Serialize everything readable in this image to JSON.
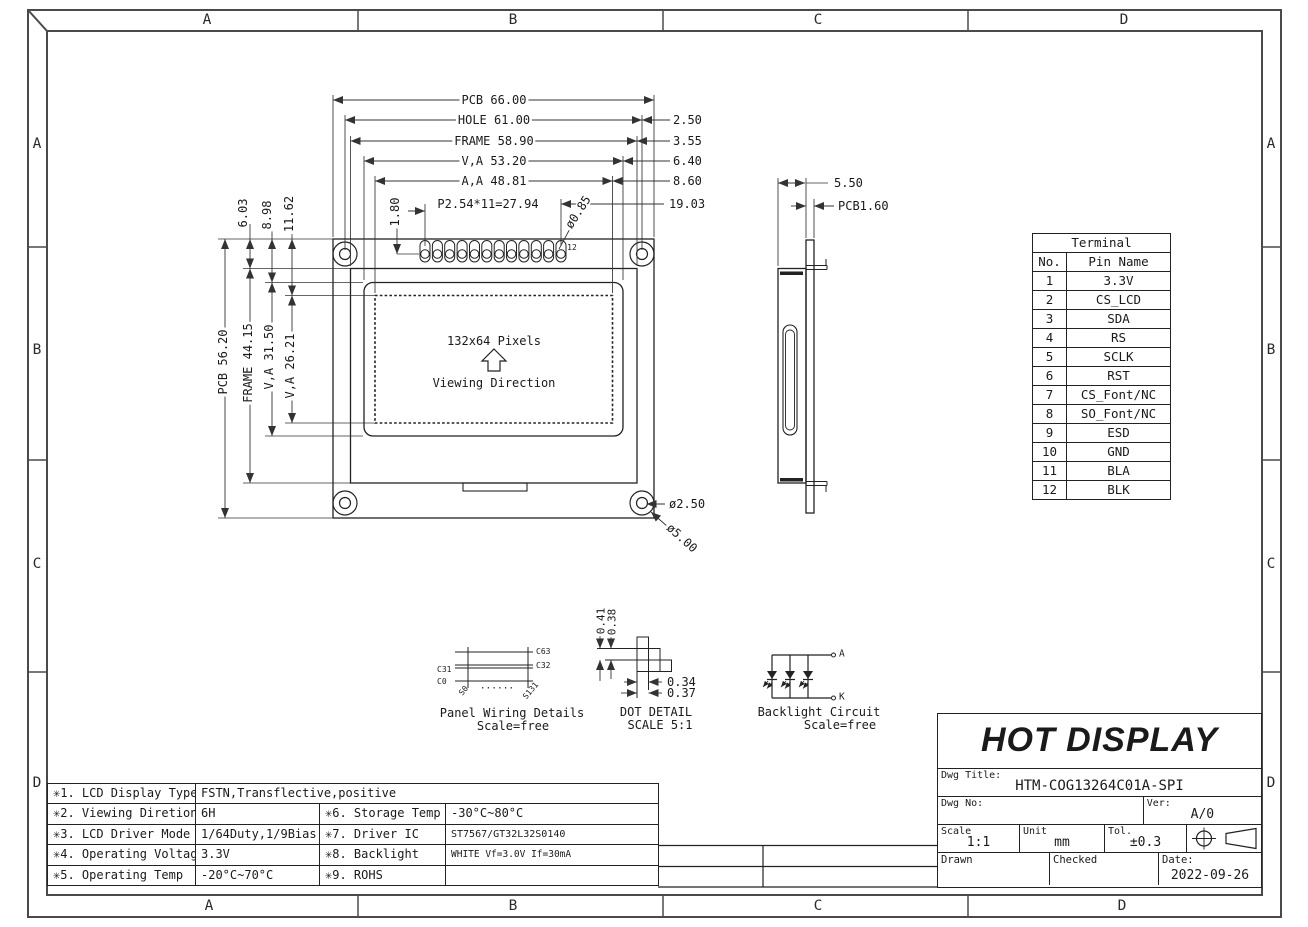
{
  "zones": {
    "cols": [
      "A",
      "B",
      "C",
      "D"
    ],
    "rows": [
      "A",
      "B",
      "C",
      "D"
    ]
  },
  "front_view": {
    "dims_top": [
      "PCB 66.00",
      "HOLE 61.00",
      "FRAME 58.90",
      "V,A 53.20",
      "A,A 48.81"
    ],
    "dims_right": [
      "2.50",
      "3.55",
      "6.40",
      "8.60",
      "19.03"
    ],
    "dims_left_upper": [
      "6.03",
      "8.98",
      "11.62"
    ],
    "dims_left": [
      "PCB 56.20",
      "FRAME 44.15",
      "V,A 31.50",
      "V,A 26.21"
    ],
    "pin_pitch": "P2.54*11=27.94",
    "pin_offset": "1.80",
    "pin_hole_dia": "ø0.85",
    "pin_last_no": "12",
    "pixels": "132x64 Pixels",
    "viewing": "Viewing Direction",
    "hole_dia": "ø2.50",
    "pad_dia": "ø5.00"
  },
  "side_view": {
    "thickness": "5.50",
    "pcb": "PCB1.60"
  },
  "terminal": {
    "title": "Terminal",
    "col_no": "No.",
    "col_name": "Pin Name",
    "rows": [
      {
        "no": "1",
        "name": "3.3V"
      },
      {
        "no": "2",
        "name": "CS_LCD"
      },
      {
        "no": "3",
        "name": "SDA"
      },
      {
        "no": "4",
        "name": "RS"
      },
      {
        "no": "5",
        "name": "SCLK"
      },
      {
        "no": "6",
        "name": "RST"
      },
      {
        "no": "7",
        "name": "CS_Font/NC"
      },
      {
        "no": "8",
        "name": "SO_Font/NC"
      },
      {
        "no": "9",
        "name": "ESD"
      },
      {
        "no": "10",
        "name": "GND"
      },
      {
        "no": "11",
        "name": "BLA"
      },
      {
        "no": "12",
        "name": "BLK"
      }
    ]
  },
  "panel_wiring": {
    "title": "Panel Wiring Details",
    "scale": "Scale=free",
    "c_top": "C63",
    "c_mid_r": "C32",
    "c_mid_l": "C31",
    "c_bot": "C0",
    "s_left": "S0",
    "s_right": "S131",
    "dots": "......"
  },
  "dot_detail": {
    "title": "DOT DETAIL",
    "scale": "SCALE 5:1",
    "h1": "0.41",
    "h2": "0.38",
    "w1": "0.34",
    "w2": "0.37"
  },
  "backlight": {
    "title": "Backlight Circuit",
    "scale": "Scale=free",
    "anode": "A",
    "cathode": "K"
  },
  "specs": {
    "rows": [
      {
        "k1": "✳1. LCD Display Type",
        "v1": "FSTN,Transflective,positive",
        "k2": "",
        "v2": ""
      },
      {
        "k1": "✳2. Viewing Diretion",
        "v1": "6H",
        "k2": "✳6. Storage Temp",
        "v2": "-30°C~80°C"
      },
      {
        "k1": "✳3. LCD Driver Mode",
        "v1": "1/64Duty,1/9Bias",
        "k2": "✳7. Driver IC",
        "v2": "ST7567/GT32L32S0140"
      },
      {
        "k1": "✳4. Operating Voltage",
        "v1": "3.3V",
        "k2": "✳8. Backlight",
        "v2": "WHITE Vf=3.0V If=30mA"
      },
      {
        "k1": "✳5. Operating Temp",
        "v1": "-20°C~70°C",
        "k2": "✳9. ROHS",
        "v2": ""
      }
    ]
  },
  "title_block": {
    "company": "HOT DISPLAY",
    "dwg_title_label": "Dwg Title:",
    "dwg_title": "HTM-COG13264C01A-SPI",
    "dwg_no_label": "Dwg No:",
    "ver_label": "Ver:",
    "version": "A/0",
    "scale_label": "Scale",
    "scale": "1:1",
    "unit_label": "Unit",
    "unit": "mm",
    "tol_label": "Tol.",
    "tol": "±0.3",
    "drawn_label": "Drawn",
    "checked_label": "Checked",
    "date_label": "Date:",
    "date": "2022-09-26"
  }
}
